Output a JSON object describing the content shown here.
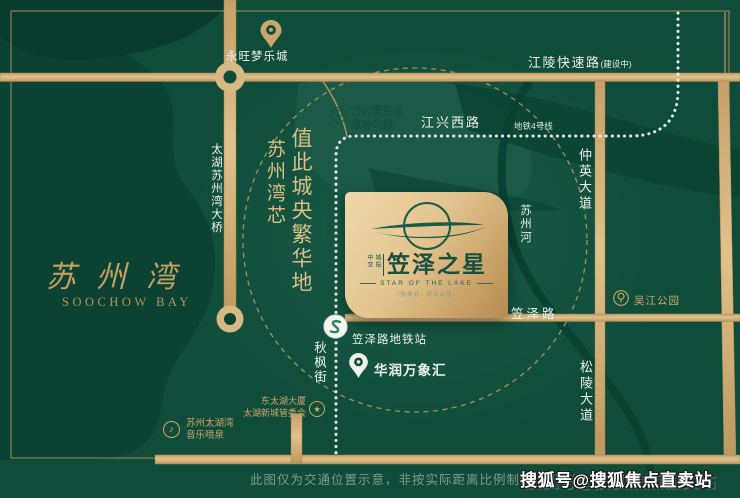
{
  "colors": {
    "background_green": "#0F4C3A",
    "lake_green": "#0B4233",
    "accent_gold": "#CDA869",
    "road_gold": "#D4B480",
    "card_gold": "#E3C48F",
    "brand_green": "#184F3F",
    "label_white": "#EEF1EA"
  },
  "icons": {
    "star": "★",
    "music": "♪"
  },
  "pois": {
    "aeon_mall": "永旺梦乐城",
    "wetland_park_line1": "万公堤生态",
    "wetland_park_line2": "湿地公园",
    "wujiang_park": "吴江公园",
    "metro_station": "笠泽路地铁站",
    "mixc": "华润万象汇",
    "donghu_tower_line1": "东太湖大厦",
    "donghu_tower_line2": "太湖新城管委会",
    "fountain_line1": "苏州太湖湾",
    "fountain_line2": "音乐喷泉"
  },
  "roads": {
    "jiangling": "江陵快速路",
    "jiangling_note": "(建设中)",
    "jiangxing": "江兴西路",
    "metro_line4": "地铁4号线",
    "zhongying": "仲英大道",
    "songling": "松陵大道",
    "suzhou_river": "苏州河",
    "taihu_bridge": "太湖苏州湾大桥",
    "lize_road": "笠泽路",
    "qiufeng": "秋枫街"
  },
  "slogan": {
    "main": "值此城央繁华地",
    "sub": "苏州湾芯"
  },
  "bay": {
    "cn": "苏州湾",
    "en": "SOOCHOW BAY"
  },
  "brand": {
    "seal_left": "中交",
    "seal_right": "城投",
    "title": "笠泽之星",
    "subtitle": "STAR OF THE LAKE",
    "tagline": "（售楼处：恭迎品鉴）"
  },
  "footer": {
    "disclaimer": "此图仅为交通位置示意，非按实际距离比例制作",
    "watermark": "搜狐号@搜狐焦点直卖站"
  }
}
